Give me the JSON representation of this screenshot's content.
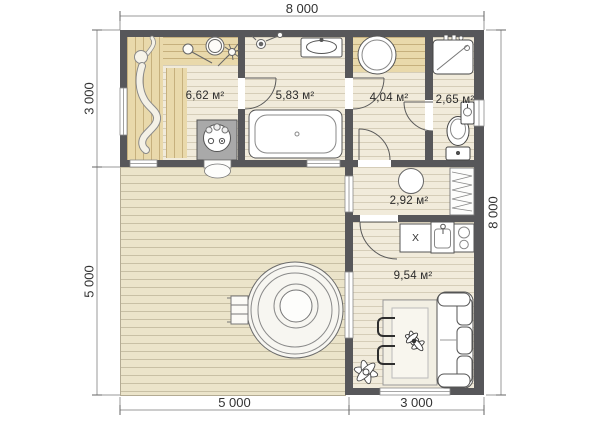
{
  "rooms": {
    "sauna": {
      "area": "6,62 м²"
    },
    "bathroom": {
      "area": "5,83 м²"
    },
    "washroom": {
      "area": "4,04 м²"
    },
    "wc": {
      "area": "2,65 м²"
    },
    "hall": {
      "area": "2,92 м²"
    },
    "lounge": {
      "area": "9,54 м²"
    }
  },
  "kitchen": {
    "appliance_label": "X"
  },
  "dimensions": {
    "top": "8 000",
    "left_upper": "3 000",
    "left_lower": "5 000",
    "right": "8 000",
    "bottom_left": "5 000",
    "bottom_right": "3 000"
  },
  "colors": {
    "wall": "#57575a",
    "floor": "#f1ebdb",
    "wood": "#e9d9ab",
    "terrace": "#ebe4ca"
  },
  "icons": {
    "hot_tub": "hot-tub-icon",
    "bathtub": "bathtub-icon",
    "toilet": "toilet-icon",
    "shower": "shower-cabin-icon",
    "stove": "sauna-stove-icon",
    "sofa": "sofa-icon",
    "stairs": "entry-stairs-icon"
  }
}
